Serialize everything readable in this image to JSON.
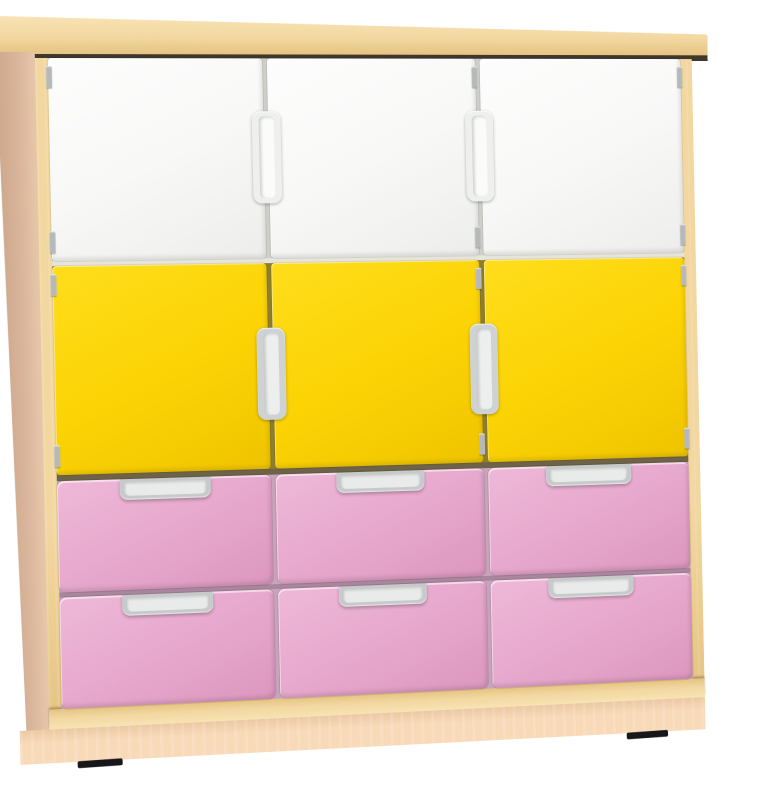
{
  "image": {
    "kind": "product-photo",
    "subject": "three-column children's storage cabinet with doors and drawers on a plinth base",
    "background_color": "#ffffff"
  },
  "cabinet": {
    "frame_color": "#f2d7a0",
    "frame_light": "#f8e3b4",
    "frame_dark": "#e5c482",
    "side_panel_color": "#d9b59b",
    "side_panel_light": "#e7c7aa",
    "side_panel_dark": "#cda78b",
    "top_shadow_color": "#3f362c",
    "plinth_color": "#f8dab9",
    "plinth_dark_color": "#ecc9a4",
    "hinge_color": "#b5b9b9",
    "foot_color": "#17171a",
    "divider_colors": [
      "#e7e4da",
      "#6e6348",
      "#aa869e"
    ],
    "rows": [
      {
        "kind": "doors",
        "name": "door-white",
        "label": "white cupboard doors",
        "count": 3,
        "panel_color_light": "#fdfdfd",
        "panel_color": "#f8f8f7",
        "panel_color_dark": "#ededeb",
        "gap_color": "#cfcfc9",
        "handle_frame_color": "#eef0ee",
        "handle_inner_color": "#fbfbfa"
      },
      {
        "kind": "doors",
        "name": "door-yellow",
        "label": "yellow cupboard doors",
        "count": 3,
        "panel_color_light": "#fedd1c",
        "panel_color": "#fcd405",
        "panel_color_dark": "#efc400",
        "gap_color": "#8f7f2b",
        "handle_frame_color": "#ced2d3",
        "handle_inner_color": "#edefee"
      },
      {
        "kind": "drawers",
        "name": "drawer-pink-upper",
        "label": "pink drawers, upper row",
        "count": 3,
        "panel_color_light": "#eeb8d8",
        "panel_color": "#e7a8cd",
        "panel_color_dark": "#dc97bf",
        "gap_color": "#c9a2bb",
        "handle_frame_color": "#c6caca",
        "handle_inner_color": "#e9ebea"
      },
      {
        "kind": "drawers",
        "name": "drawer-pink-lower",
        "label": "pink drawers, lower row",
        "count": 3,
        "panel_color_light": "#eeb8d8",
        "panel_color": "#e7a8cd",
        "panel_color_dark": "#dc97bf",
        "gap_color": "#c9a2bb",
        "handle_frame_color": "#c6caca",
        "handle_inner_color": "#e9ebea"
      }
    ]
  }
}
